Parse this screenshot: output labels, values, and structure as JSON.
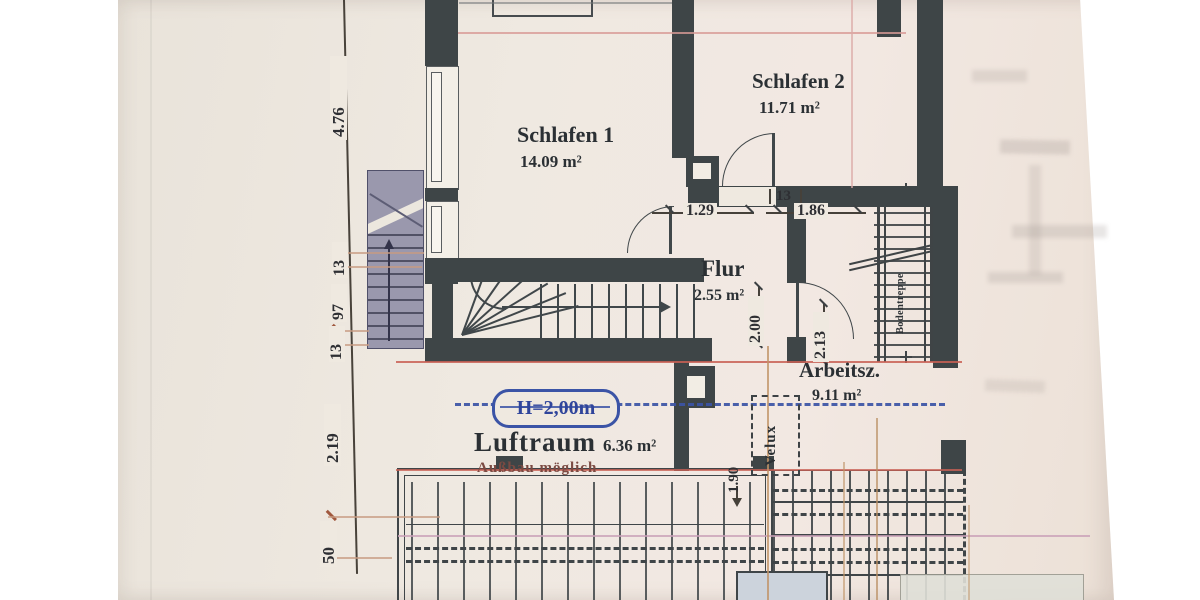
{
  "rooms": {
    "schlafen1": {
      "name": "Schlafen 1",
      "area": "14.09 m²"
    },
    "schlafen2": {
      "name": "Schlafen 2",
      "area": "11.71 m²"
    },
    "flur": {
      "name": "Flur",
      "area": "2.55 m²"
    },
    "arbeitszimmer": {
      "name": "Arbeitsz.",
      "area": "9.11 m²"
    },
    "luftraum": {
      "name": "Luftraum",
      "area": "6.36 m²"
    }
  },
  "annotations": {
    "ausbau": "Außbau möglich",
    "height_marker": "H=2,00m",
    "skylight": "Velux",
    "ladder": "Bodentreppe"
  },
  "dimensions": {
    "left_total": "4.76",
    "left_13_upper": "13",
    "left_97": "97",
    "left_13_lower": "13",
    "left_219": "2.19",
    "left_50": "50",
    "opening_129": "1.29",
    "opening_13": "13",
    "opening_186": "1.86",
    "flur_depth": "2.00",
    "arbeitsz_width": "2.13",
    "velux_height": "1.90"
  },
  "colors": {
    "wall": "#3e4547",
    "paper": "#efe9e0",
    "height_line_blue": "#3a53a4",
    "section_line_red": "#c96055",
    "tick_brown": "#a0583e",
    "stair_fill": "#9a98ad"
  }
}
